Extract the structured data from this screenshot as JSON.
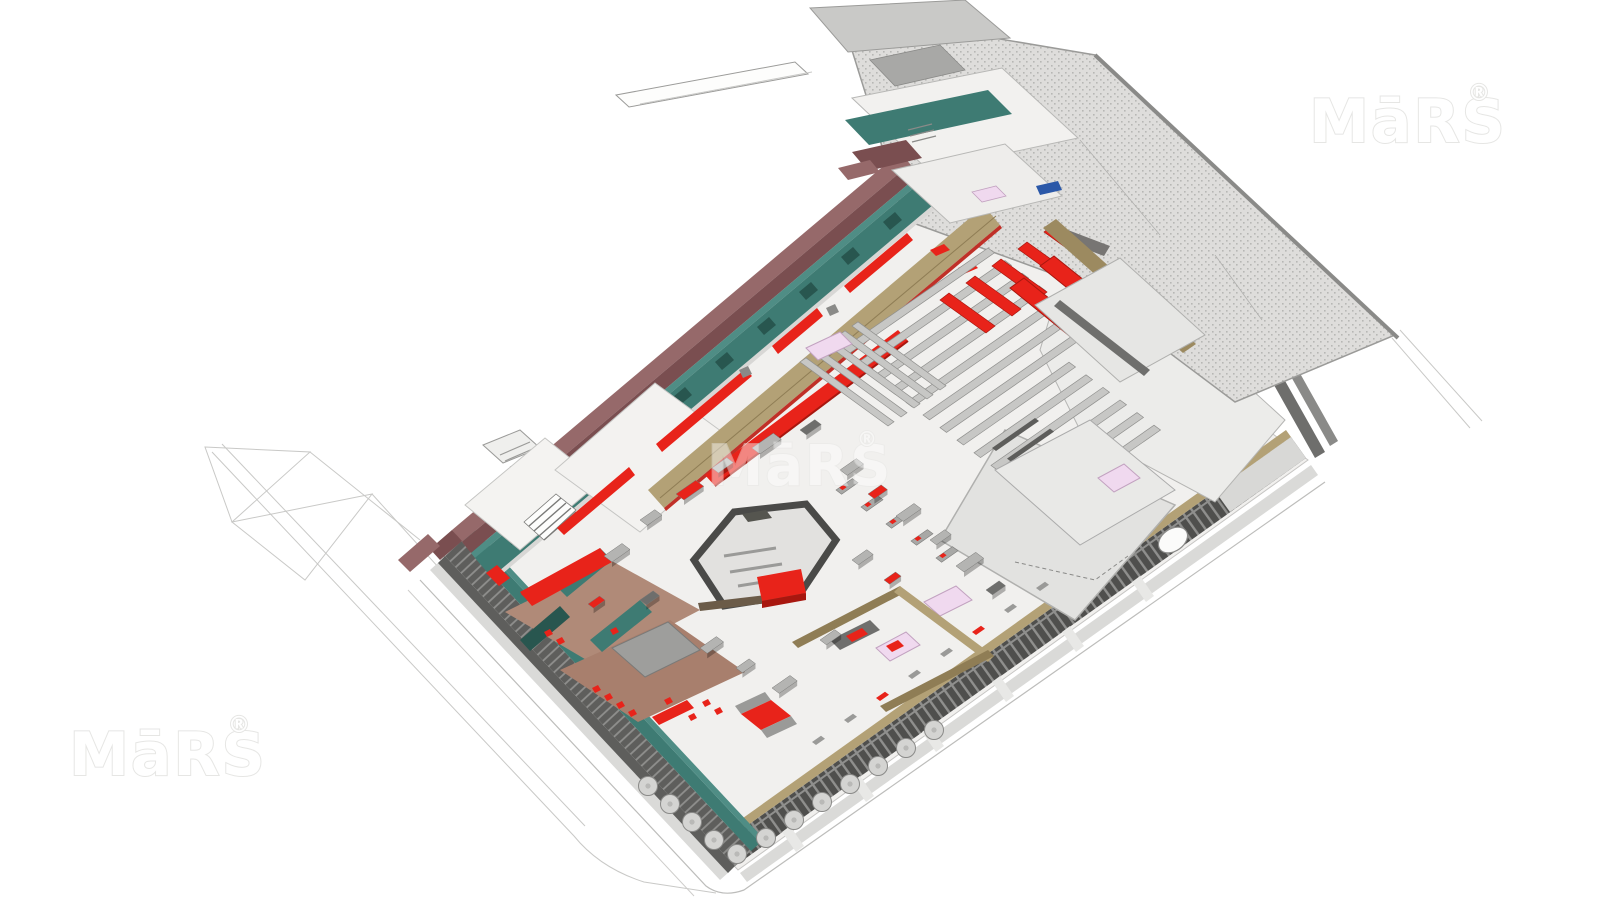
{
  "page": {
    "background": "#ffffff"
  },
  "watermarks": {
    "text": "MāRS",
    "registered_mark": "®",
    "color": "#e6e6e4",
    "positions": [
      "top-right",
      "center",
      "bottom-left"
    ]
  },
  "colors": {
    "white": "#ffffff",
    "floor": "#f1f0ee",
    "floor_line": "#c6c5c3",
    "sidewalk": "#dadad8",
    "wireframe": "#c9c9c7",
    "watermark": "#e6e6e4",
    "stipple_base": "#dedddb",
    "stipple_dot": "#b7b7b4",
    "roof_light": "#ececea",
    "roof_mid": "#e2e2e0",
    "roof_edge": "#9b9b99",
    "teal": "#3e7b73",
    "teal_dark": "#28564f",
    "teal_top": "#4f8d85",
    "maroon": "#96696a",
    "maroon_dark": "#7a4e50",
    "red": "#e8231a",
    "red_dark": "#a8170f",
    "tan": "#b3a176",
    "tan_dark": "#8f7d55",
    "khaki_wall": "#9c8a60",
    "shelf": "#c7c7c5",
    "shelf_side": "#90908e",
    "gray_wall": "#8b8b89",
    "gray_dark": "#5e5e5c",
    "facade_dark": "#4f4f4d",
    "facade_stripe": "#8f8f8d",
    "island_top": "#4a4a48",
    "island_wood": "#6b5b48",
    "terracotta": "#b08a78",
    "lavender": "#f0d9ef",
    "lavender_edge": "#c2a2c0",
    "blue_sign": "#2b58a8",
    "umbrella": "#d4d4d2",
    "kiosk_gray": "#b4b4b2",
    "kiosk_dark": "#6e6e6c"
  },
  "model": {
    "parts": [
      "site-wireframe",
      "main-floor-plate",
      "sidewalk",
      "southeast-colonnade-facade",
      "southwest-teal-wall",
      "northwest-maroon-parapet-wall",
      "northwest-red-canopies",
      "market-street-tan-walkway",
      "north-annex-roofs",
      "northeast-stippled-roof-wing",
      "east-white-roof-wing",
      "supermarket-shelving-rows",
      "refrigerated-red-cases",
      "red-seating-rows",
      "central-island-counter",
      "southwest-food-stalls",
      "south-tan-stalls",
      "east-rooms",
      "skylights",
      "checkout-counters",
      "floor-kiosks",
      "outdoor-umbrella-tables"
    ]
  }
}
